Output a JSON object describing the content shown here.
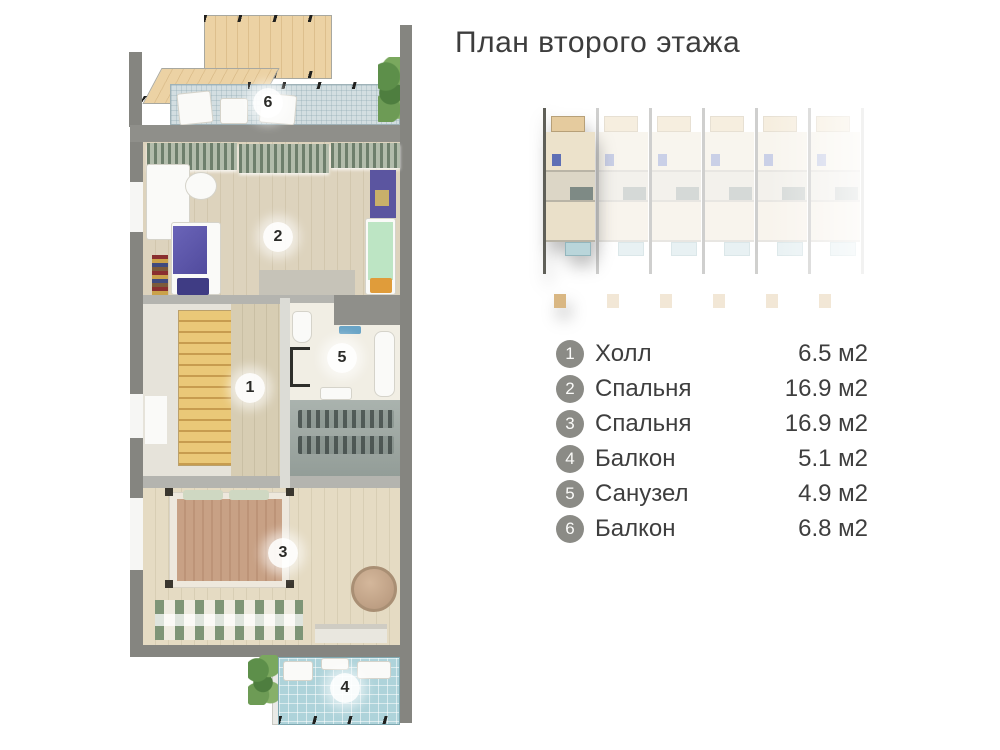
{
  "title": "План второго этажа",
  "floor_plan": {
    "rooms": [
      {
        "number": "1",
        "label": "Холл",
        "area": "6.5 м2"
      },
      {
        "number": "2",
        "label": "Спальня",
        "area": "16.9 м2"
      },
      {
        "number": "3",
        "label": "Спальня",
        "area": "16.9 м2"
      },
      {
        "number": "4",
        "label": "Балкон",
        "area": "5.1 м2"
      },
      {
        "number": "5",
        "label": "Санузел",
        "area": "4.9 м2"
      },
      {
        "number": "6",
        "label": "Балкон",
        "area": "6.8 м2"
      }
    ]
  },
  "building_overview": {
    "units": 6,
    "highlighted_unit": 1
  },
  "colors": {
    "text": "#3d3d3d",
    "legend_circle": "#8b8b86",
    "wall": "#858580",
    "wood_floor": "#ddd3bd",
    "balcony_tile": "#aed3da"
  }
}
